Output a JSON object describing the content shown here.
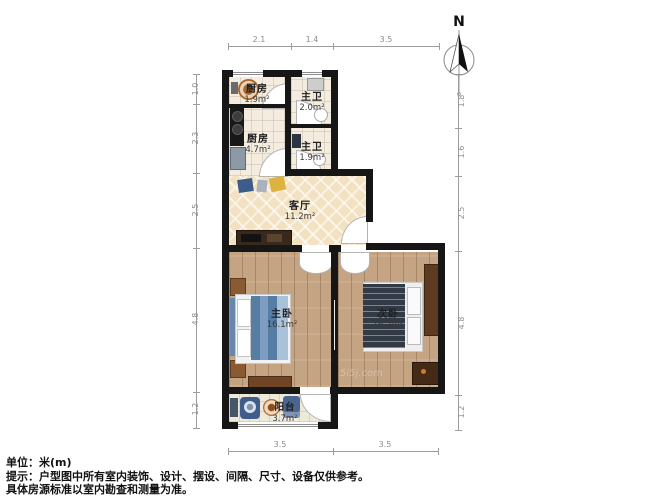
{
  "compass": {
    "label": "N"
  },
  "rooms": [
    {
      "id": "kitchen-small",
      "name": "厨房",
      "area": "1.9m²"
    },
    {
      "id": "bath-top",
      "name": "主卫",
      "area": "2.0m²"
    },
    {
      "id": "kitchen-main",
      "name": "厨房",
      "area": "4.7m²"
    },
    {
      "id": "bath-bottom",
      "name": "主卫",
      "area": "1.9m²"
    },
    {
      "id": "living-room",
      "name": "客厅",
      "area": "11.2m²"
    },
    {
      "id": "master-bedroom",
      "name": "主卧",
      "area": "16.1m²"
    },
    {
      "id": "second-bedroom",
      "name": "次卧",
      "area": "16.2m²"
    },
    {
      "id": "balcony",
      "name": "阳台",
      "area": "3.7m²"
    }
  ],
  "dimensions": {
    "unit": "米(m)",
    "top": [
      "2.1",
      "1.4",
      "3.5"
    ],
    "bottom": [
      "3.5",
      "3.5"
    ],
    "left": [
      "1.0",
      "2.3",
      "2.5",
      "4.8",
      "1.2"
    ],
    "right": [
      "1.8",
      "1.6",
      "2.5",
      "4.8",
      "1.2"
    ]
  },
  "footer": {
    "unit_line": "单位：米(m)",
    "tip_line": "提示：户型图中所有室内装饰、设计、摆设、间隔、尺寸、设备仅供参考。",
    "standard_line": "具体房源标准以室内勘查和测量为准。"
  },
  "watermark": "5i5j.com",
  "colors": {
    "wall": "#161616",
    "living_floor": "#f2e2c2",
    "bedroom_floor": "#c4a483",
    "tile_floor": "#f3ecdf",
    "dimension": "#9d9d9d",
    "bed_blanket_blue": "#567da3",
    "bed_blanket_dark": "#323a46",
    "accent_orange": "#b06d30",
    "accent_yellow": "#ddb23f"
  }
}
